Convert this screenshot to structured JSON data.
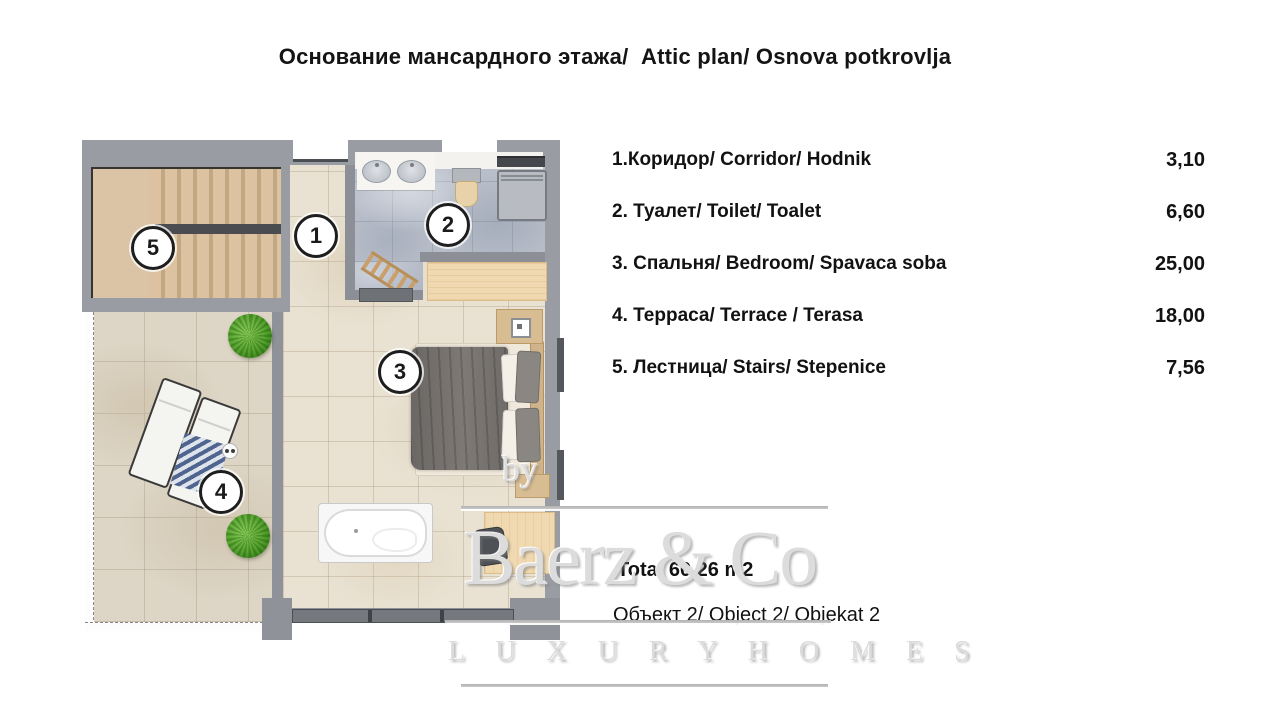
{
  "title": "Основание мансардного этажа/  Attic plan/ Osnova potkrovlja",
  "legend": {
    "items": [
      {
        "num": "1",
        "label": "1.Коридор/ Corridor/ Hodnik",
        "area": "3,10"
      },
      {
        "num": "2",
        "label": "2. Туалет/ Toilet/ Toalet",
        "area": "6,60"
      },
      {
        "num": "3",
        "label": "3. Спальня/ Bedroom/ Spavaca soba",
        "area": "25,00"
      },
      {
        "num": "4",
        "label": "4. Терраса/ Terrace / Terasa",
        "area": "18,00"
      },
      {
        "num": "5",
        "label": "5. Лестница/ Stairs/ Stepenice",
        "area": "7,56"
      }
    ]
  },
  "summary": {
    "total": "Total 60,26 m2",
    "object_line": "Объект 2/ Object 2/ Objekat 2"
  },
  "watermark": {
    "by": "by",
    "brand": "Baerz & Co",
    "tagline": "L U X U R Y   H O M E S"
  },
  "palette": {
    "wall_gray": "#999da3",
    "floor_tile": "#e9e2d3",
    "terrace_tile": "#ddd5c5",
    "toilet_tile": "#b9bfca",
    "stair_wood": "#dcc2a1",
    "furniture_wood": "#f0d9b0",
    "plant_green": "#53a12c"
  }
}
